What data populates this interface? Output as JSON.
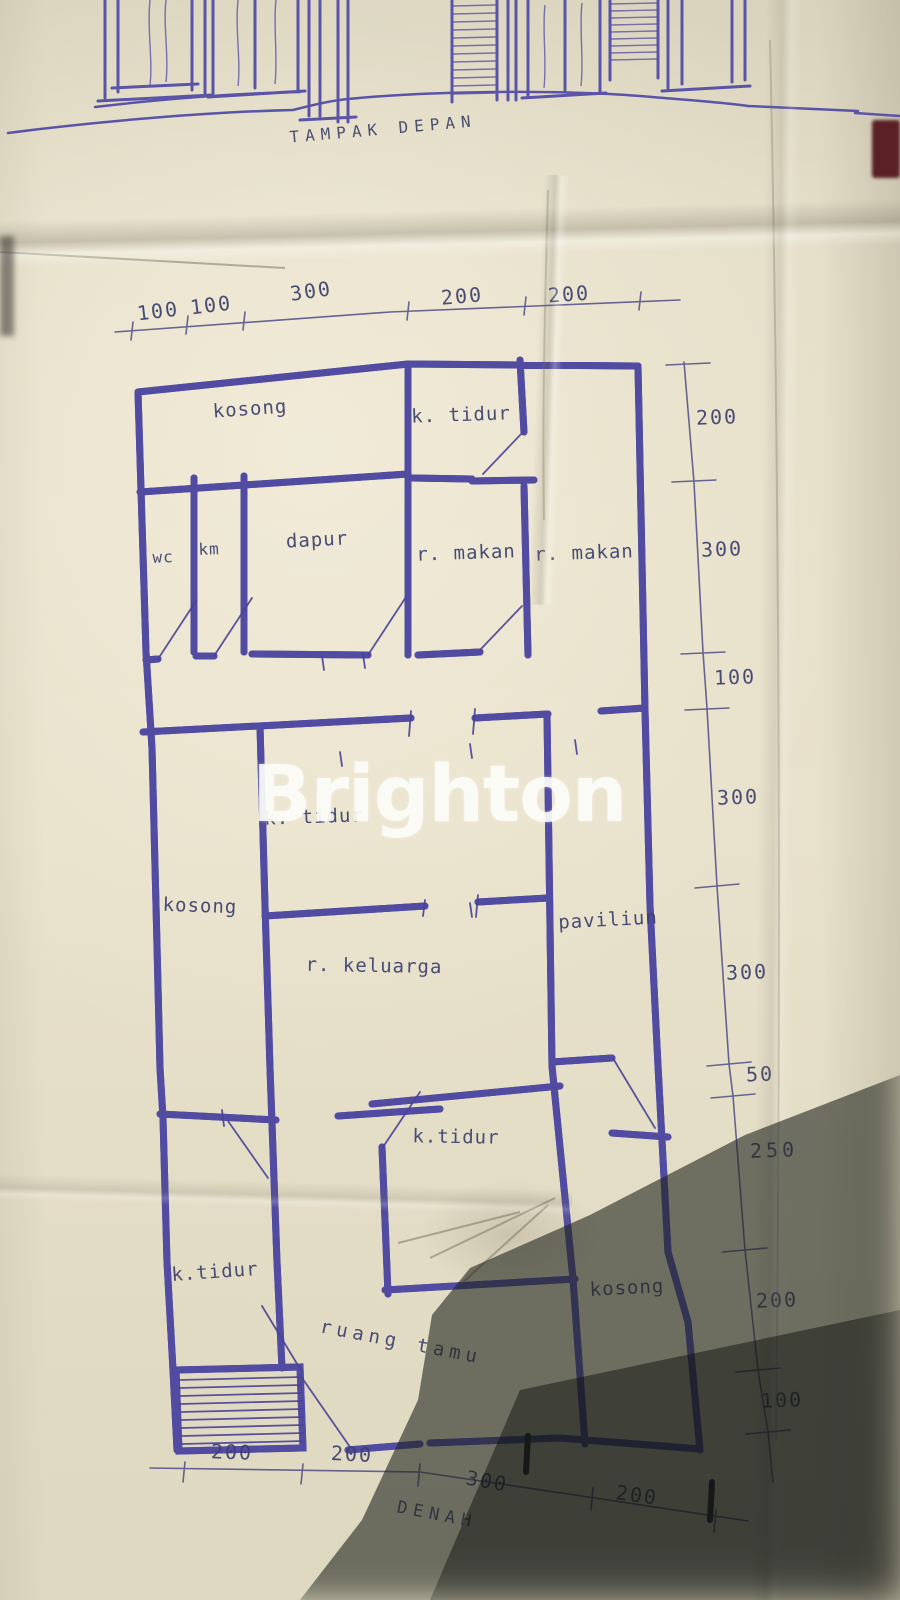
{
  "watermark": {
    "text": "Brighton"
  },
  "titles": {
    "front_view": "TAMPAK DEPAN",
    "plan": "DENAH"
  },
  "colors": {
    "ink": "#514ba2",
    "paper": "#e6dfc9",
    "watermark": "#fcfcf8",
    "shadow": "#20241e"
  },
  "plan": {
    "top_dims": [
      "100",
      "100",
      "300",
      "200",
      "200"
    ],
    "right_dims": [
      "200",
      "300",
      "100",
      "300",
      "300",
      "50",
      "250",
      "200",
      "100"
    ],
    "bottom_dims": [
      "200",
      "200",
      "300",
      "200"
    ],
    "rooms": {
      "kosong_top": "kosong",
      "ktidur_top": "k. tidur",
      "wc": "wc",
      "km": "km",
      "dapur": "dapur",
      "rmakan_a": "r. makan",
      "rmakan_b": "r. makan",
      "ktidur_mid": "k. tidur",
      "kosong_left": "kosong",
      "paviliun": "paviliun",
      "rkeluarga": "r. keluarga",
      "ktidur_lower": "k.tidur",
      "ktidur_bottom": "k.tidur",
      "kosong_bottom": "kosong",
      "ruang_tamu": "ruang tamu"
    }
  }
}
